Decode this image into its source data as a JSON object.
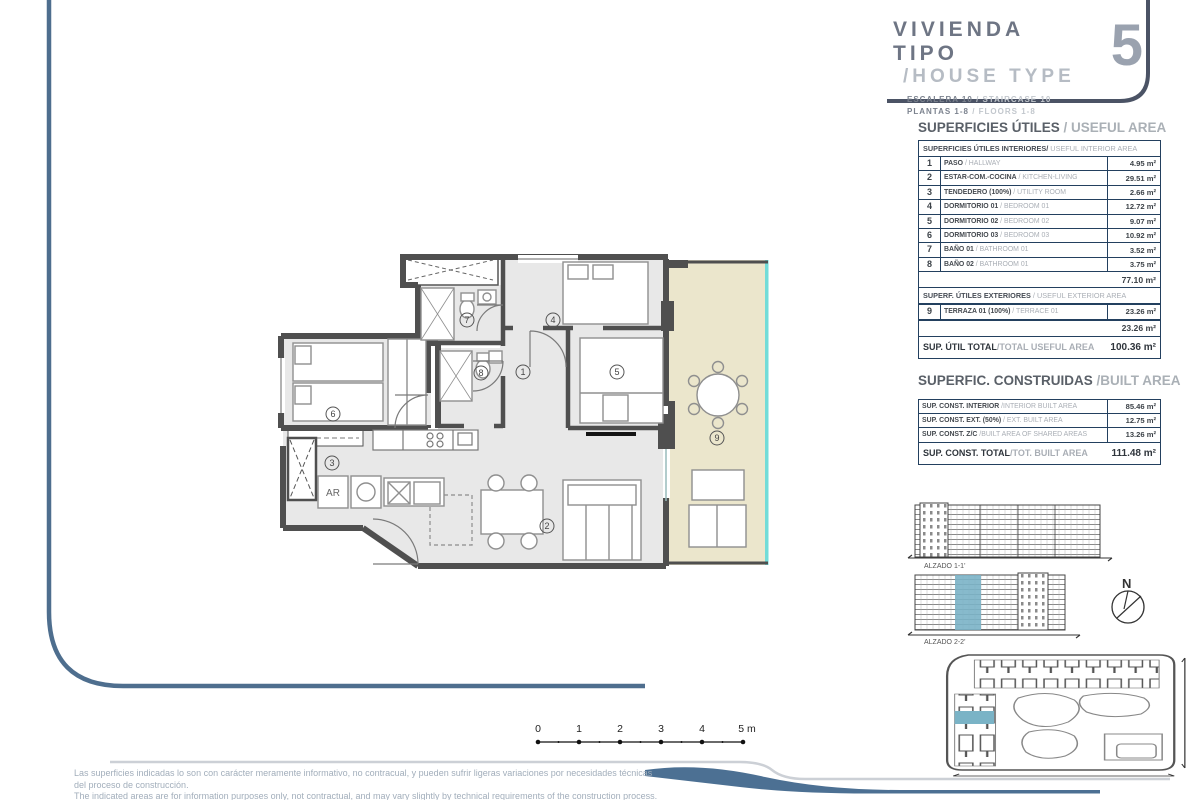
{
  "title_block": {
    "line1": "VIVIENDA TIPO",
    "line2": "/HOUSE TYPE",
    "number": "5",
    "sub_es1": "ESCALERA 10",
    "sub_en1": "/ STAIRCASE 10",
    "sub_es2": "PLANTAS 1-8",
    "sub_en2": "/ FLOORS 1-8"
  },
  "useful": {
    "title_es": "SUPERFICIES ÚTILES",
    "title_en": " / USEFUL AREA",
    "interior_header_es": "SUPERFICIES ÚTILES INTERIORES/",
    "interior_header_en": " USEFUL INTERIOR AREA",
    "rows": [
      {
        "num": "1",
        "es": "PASO",
        "en": " / HALLWAY",
        "val": "4.95 m²"
      },
      {
        "num": "2",
        "es": "ESTAR-COM.-COCINA",
        "en": " / KITCHEN-LIVING",
        "val": "29.51 m²"
      },
      {
        "num": "3",
        "es": "TENDEDERO (100%)",
        "en": " / UTILITY ROOM",
        "val": "2.66 m²"
      },
      {
        "num": "4",
        "es": "DORMITORIO 01",
        "en": " / BEDROOM 01",
        "val": "12.72 m²"
      },
      {
        "num": "5",
        "es": "DORMITORIO 02",
        "en": " / BEDROOM 02",
        "val": "9.07 m²"
      },
      {
        "num": "6",
        "es": "DORMITORIO 03",
        "en": " / BEDROOM 03",
        "val": "10.92 m²"
      },
      {
        "num": "7",
        "es": "BAÑO 01",
        "en": " / BATHROOM 01",
        "val": "3.52 m²"
      },
      {
        "num": "8",
        "es": "BAÑO 02",
        "en": " / BATHROOM 01",
        "val": "3.75 m²"
      }
    ],
    "interior_subtotal": "77.10 m²",
    "exterior_header_es": "SUPERF. ÚTILES EXTERIORES",
    "exterior_header_en": " / USEFUL EXTERIOR AREA",
    "exterior_row": {
      "num": "9",
      "es": "TERRAZA 01 (100%)",
      "en": " / TERRACE 01",
      "val": "23.26 m²"
    },
    "exterior_subtotal": "23.26 m²",
    "total_label_es": "SUP. ÚTIL TOTAL",
    "total_label_en": "/TOTAL USEFUL AREA",
    "total_value": "100.36 m²"
  },
  "built": {
    "title_es": "SUPERFIC. CONSTRUIDAS",
    "title_en": " /BUILT AREA",
    "rows": [
      {
        "es": "SUP. CONST. INTERIOR",
        "en": " /INTERIOR BUILT AREA",
        "val": "85.46 m²"
      },
      {
        "es": "SUP. CONST. EXT. (50%)",
        "en": " / EXT. BUILT AREA",
        "val": "12.75 m²"
      },
      {
        "es": "SUP. CONST. Z/C",
        "en": " /BUILT AREA OF SHARED AREAS",
        "val": "13.26 m²"
      }
    ],
    "total_label_es": "SUP. CONST. TOTAL",
    "total_label_en": "/TOT. BUILT AREA",
    "total_value": "111.48 m²"
  },
  "plan": {
    "rooms": [
      "1",
      "2",
      "3",
      "4",
      "5",
      "6",
      "7",
      "8",
      "9"
    ],
    "ar_label": "AR"
  },
  "elevations": {
    "alzado1": "ALZADO 1-1'",
    "alzado2": "ALZADO 2-2'",
    "north": "N"
  },
  "scalebar": {
    "labels": [
      "0",
      "1",
      "2",
      "3",
      "4",
      "5 m"
    ]
  },
  "disclaimer": {
    "es1": "Las superficies indicadas lo son con carácter meramente informativo, no contracual, y pueden sufrir ligeras variaciones por necesidades técnicas",
    "es2": "del proceso de construcción.",
    "en": "The indicated areas are for information purposes only, not contractual, and may vary slightly by technical requirements of the construction process."
  },
  "colors": {
    "frame": "#4e6e8e",
    "title_frame": "#4b5365",
    "table_border": "#23405f",
    "wall": "#4f4f4f",
    "floor": "#e8e8e8",
    "terrace": "#ebe6cc",
    "terrace_edge": "#72dcd8",
    "highlight": "#7ab3c6",
    "swoosh": "#4c7093"
  }
}
